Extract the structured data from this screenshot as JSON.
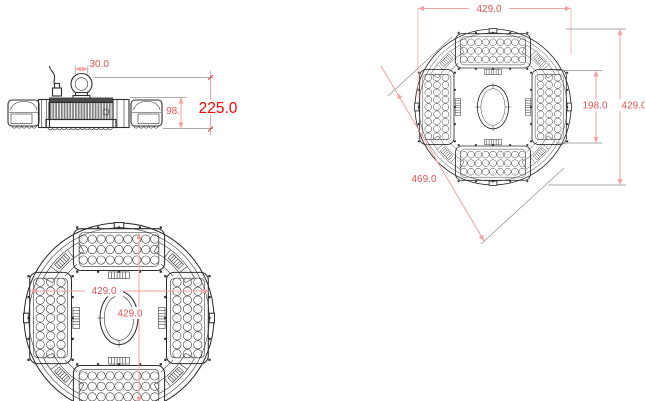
{
  "colors": {
    "line": "#2e2e2e",
    "ext_line": "#8f8f8f",
    "dim_line": "#f2a2a2",
    "dim_text": "#e05252",
    "total_text": "#ff0000",
    "bg": "#ffffff"
  },
  "side_view": {
    "hook_width": "30.0",
    "body_height": "98.",
    "overall_height": "225.0"
  },
  "top_right_view": {
    "width": "429.0",
    "center_span": "198.0",
    "height": "429.0",
    "diagonal": "469.0"
  },
  "bottom_left_view": {
    "width": "429.0",
    "height": "429.0"
  }
}
